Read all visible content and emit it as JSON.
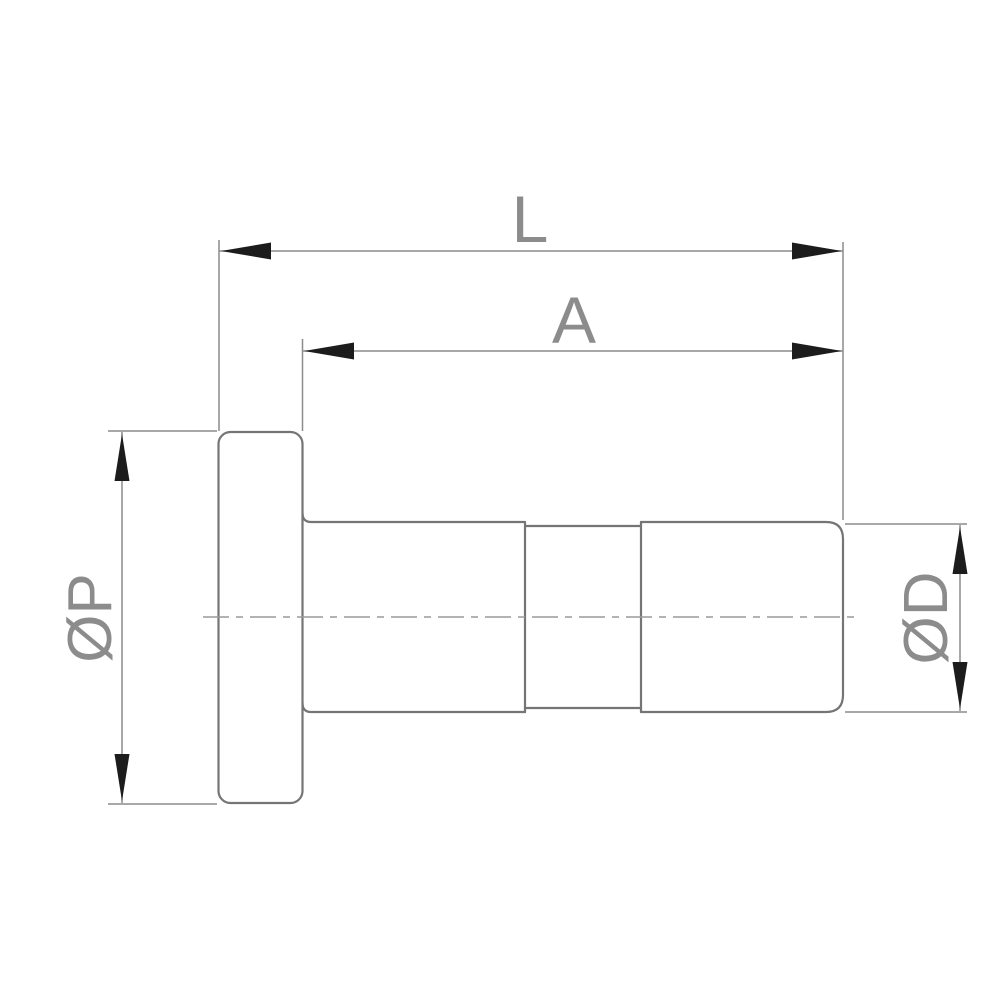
{
  "drawing": {
    "labels": {
      "total_length": "L",
      "body_length": "A",
      "flange_diameter": "ØP",
      "body_diameter": "ØD"
    },
    "colors": {
      "background": "#ffffff",
      "outline": "#757575",
      "dimension_lines": "#8c8c8c",
      "centerline": "#9a9a9a",
      "arrowheads": "#1c1c1c",
      "label_text": "#8c8c8c"
    }
  }
}
